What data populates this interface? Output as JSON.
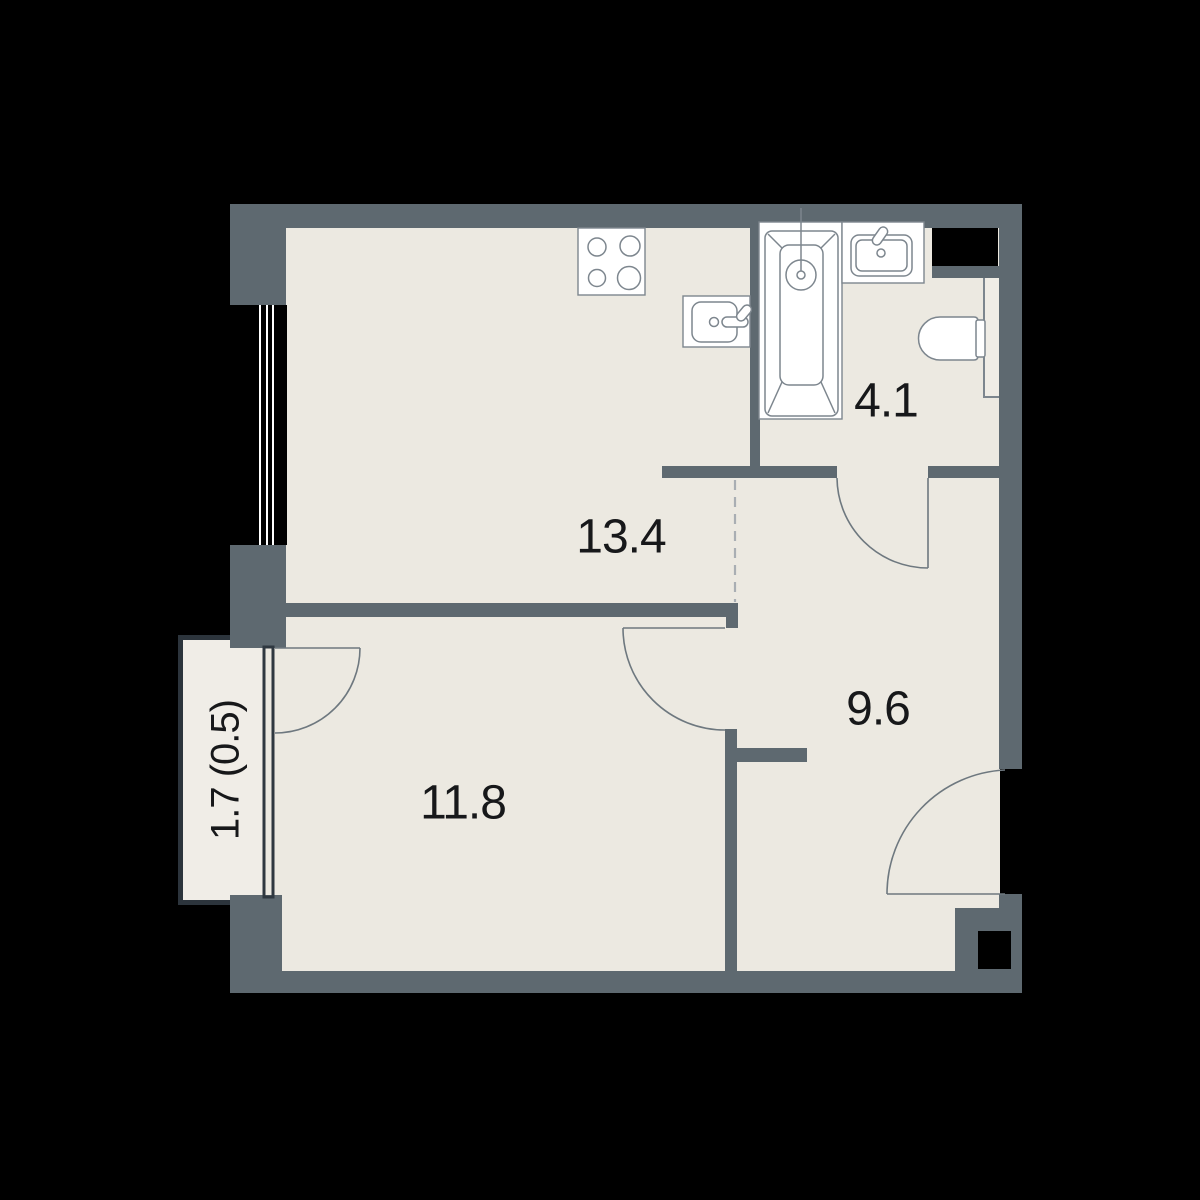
{
  "title": "Apartment floor plan",
  "colors": {
    "background": "#000000",
    "wall": "#5e6970",
    "floor": "#ece9e1",
    "balcony_floor": "#f0ede7",
    "balcony_border": "#2c343c",
    "window_dark": "#2f3840",
    "fixture_outline": "#7d868e",
    "fixture_fill": "#ffffff",
    "door_line": "#6e787f",
    "dashed_line": "#a9aeb3",
    "label_text": "#17181a",
    "niche": "#f0ede6"
  },
  "rooms": [
    {
      "name": "kitchen-living-room",
      "area_label": "13.4"
    },
    {
      "name": "bathroom",
      "area_label": "4.1"
    },
    {
      "name": "hallway",
      "area_label": "9.6"
    },
    {
      "name": "bedroom",
      "area_label": "11.8"
    },
    {
      "name": "balcony",
      "area_label": "1.7 (0.5)"
    }
  ],
  "fixtures": [
    {
      "icon": "stove-icon"
    },
    {
      "icon": "kitchen-sink-icon"
    },
    {
      "icon": "bathtub-icon"
    },
    {
      "icon": "shower-icon"
    },
    {
      "icon": "washbasin-icon"
    },
    {
      "icon": "toilet-icon"
    },
    {
      "icon": "duct-shaft-icon"
    }
  ]
}
